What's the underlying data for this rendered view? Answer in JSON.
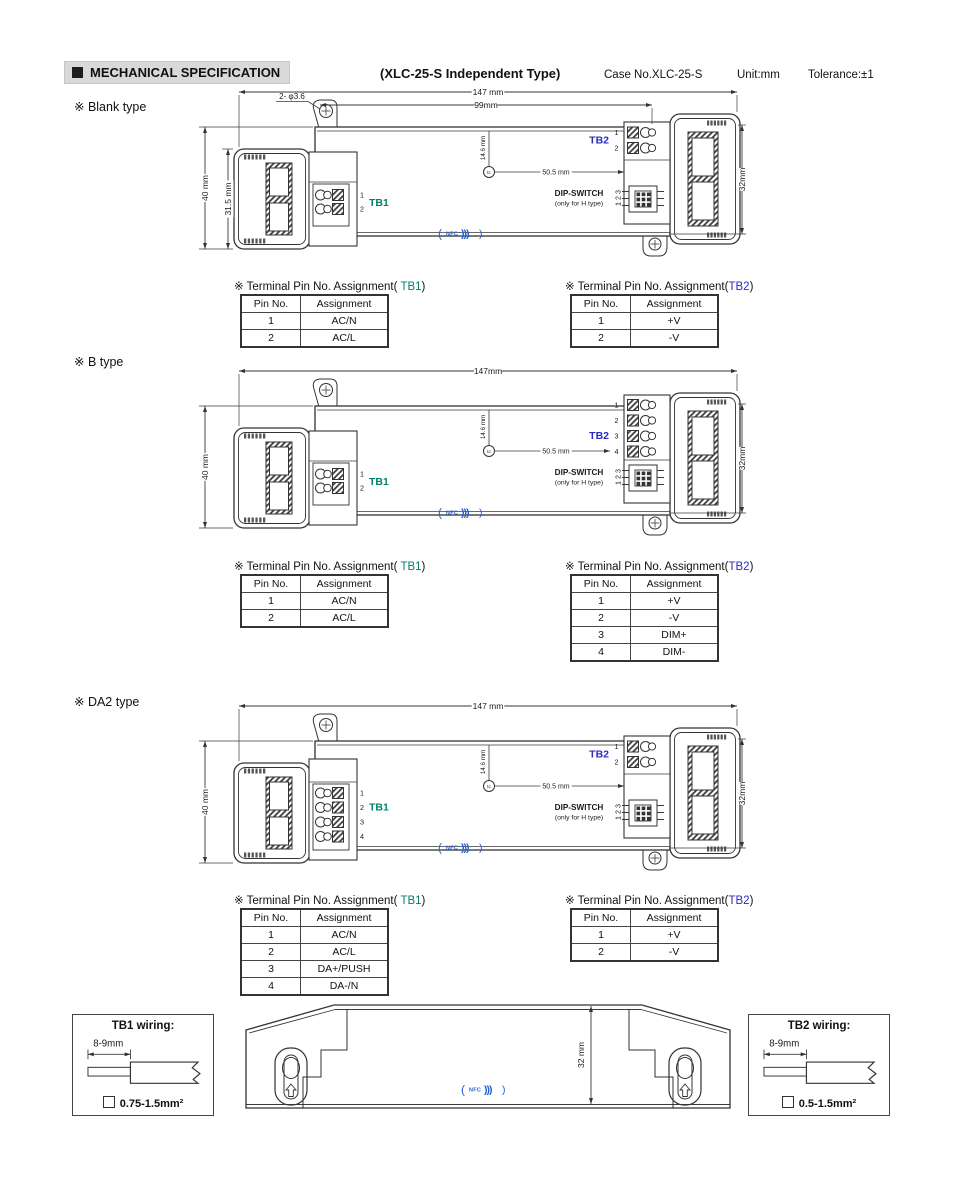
{
  "header": {
    "badge_label": "MECHANICAL SPECIFICATION",
    "title": "(XLC-25-S Independent Type)",
    "case_no": "Case No.XLC-25-S",
    "unit": "Unit:mm",
    "tolerance": "Tolerance:±1"
  },
  "colors": {
    "tb1": "#00806E",
    "tb2": "#2B2BC4",
    "nfc": "#2060D8",
    "line": "#333333"
  },
  "sections": {
    "blank": {
      "label": "※ Blank type",
      "drawing": {
        "dim_length": "147 mm",
        "dim_mount": "99mm",
        "hole_note": "2- φ3.6",
        "dim_height": "40 mm",
        "dim_cap_height": "31.5 mm",
        "dim_depth": "32mm",
        "dim_tc_x": "50.5 mm",
        "dim_tc_y": "14.6 mm",
        "tc_label": "tc",
        "tb1_label": "TB1",
        "tb1_pins": [
          "1",
          "2"
        ],
        "tb2_label": "TB2",
        "tb2_pins": [
          "1",
          "2"
        ],
        "dip_line1": "DIP-SWITCH",
        "dip_line2": "(only for H type)",
        "dip_pins": "1 2 3",
        "nfc_label": "NFC"
      },
      "tb1_table": {
        "title_prefix": "※ Terminal Pin No. Assignment(",
        "title_tb": " TB1",
        "title_suffix": ")",
        "headers": [
          "Pin No.",
          "Assignment"
        ],
        "rows": [
          [
            "1",
            "AC/N"
          ],
          [
            "2",
            "AC/L"
          ]
        ]
      },
      "tb2_table": {
        "title_prefix": "※ Terminal Pin No. Assignment(",
        "title_tb": "TB2",
        "title_suffix": ")",
        "headers": [
          "Pin No.",
          "Assignment"
        ],
        "rows": [
          [
            "1",
            "+V"
          ],
          [
            "2",
            "-V"
          ]
        ]
      }
    },
    "b": {
      "label": "※ B type",
      "drawing": {
        "dim_length": "147mm",
        "dim_height": "40 mm",
        "dim_depth": "32mm",
        "dim_tc_x": "50.5 mm",
        "dim_tc_y": "14.6 mm",
        "tc_label": "tc",
        "tb1_label": "TB1",
        "tb1_pins": [
          "1",
          "2"
        ],
        "tb2_label": "TB2",
        "tb2_pins": [
          "1",
          "2",
          "3",
          "4"
        ],
        "dip_line1": "DIP-SWITCH",
        "dip_line2": "(only for H type)",
        "dip_pins": "1 2 3",
        "nfc_label": "NFC"
      },
      "tb1_table": {
        "title_prefix": "※ Terminal Pin No. Assignment(",
        "title_tb": " TB1",
        "title_suffix": ")",
        "headers": [
          "Pin No.",
          "Assignment"
        ],
        "rows": [
          [
            "1",
            "AC/N"
          ],
          [
            "2",
            "AC/L"
          ]
        ]
      },
      "tb2_table": {
        "title_prefix": "※ Terminal Pin No. Assignment(",
        "title_tb": "TB2",
        "title_suffix": ")",
        "headers": [
          "Pin No.",
          "Assignment"
        ],
        "rows": [
          [
            "1",
            "+V"
          ],
          [
            "2",
            "-V"
          ],
          [
            "3",
            "DIM+"
          ],
          [
            "4",
            "DIM-"
          ]
        ]
      }
    },
    "da2": {
      "label": "※ DA2 type",
      "drawing": {
        "dim_length": "147 mm",
        "dim_height": "40 mm",
        "dim_depth": "32mm",
        "dim_tc_x": "50.5 mm",
        "dim_tc_y": "14.6 mm",
        "tc_label": "tc",
        "tb1_label": "TB1",
        "tb1_pins": [
          "1",
          "2",
          "3",
          "4"
        ],
        "tb2_label": "TB2",
        "tb2_pins": [
          "1",
          "2"
        ],
        "dip_line1": "DIP-SWITCH",
        "dip_line2": "(only for H type)",
        "dip_pins": "1 2 3",
        "nfc_label": "NFC"
      },
      "tb1_table": {
        "title_prefix": "※ Terminal Pin No. Assignment(",
        "title_tb": " TB1",
        "title_suffix": ")",
        "headers": [
          "Pin No.",
          "Assignment"
        ],
        "rows": [
          [
            "1",
            "AC/N"
          ],
          [
            "2",
            "AC/L"
          ],
          [
            "3",
            "DA+/PUSH"
          ],
          [
            "4",
            "DA-/N"
          ]
        ]
      },
      "tb2_table": {
        "title_prefix": "※ Terminal Pin No. Assignment(",
        "title_tb": "TB2",
        "title_suffix": ")",
        "headers": [
          "Pin No.",
          "Assignment"
        ],
        "rows": [
          [
            "1",
            "+V"
          ],
          [
            "2",
            "-V"
          ]
        ]
      }
    }
  },
  "footer": {
    "tb1_box": {
      "title": "TB1 wiring:",
      "strip_dim": "8-9mm",
      "wire_spec": "0.75-1.5mm²"
    },
    "tb2_box": {
      "title": "TB2 wiring:",
      "strip_dim": "8-9mm",
      "wire_spec": "0.5-1.5mm²"
    },
    "profile": {
      "dim_depth": "32 mm",
      "nfc_label": "NFC"
    }
  }
}
